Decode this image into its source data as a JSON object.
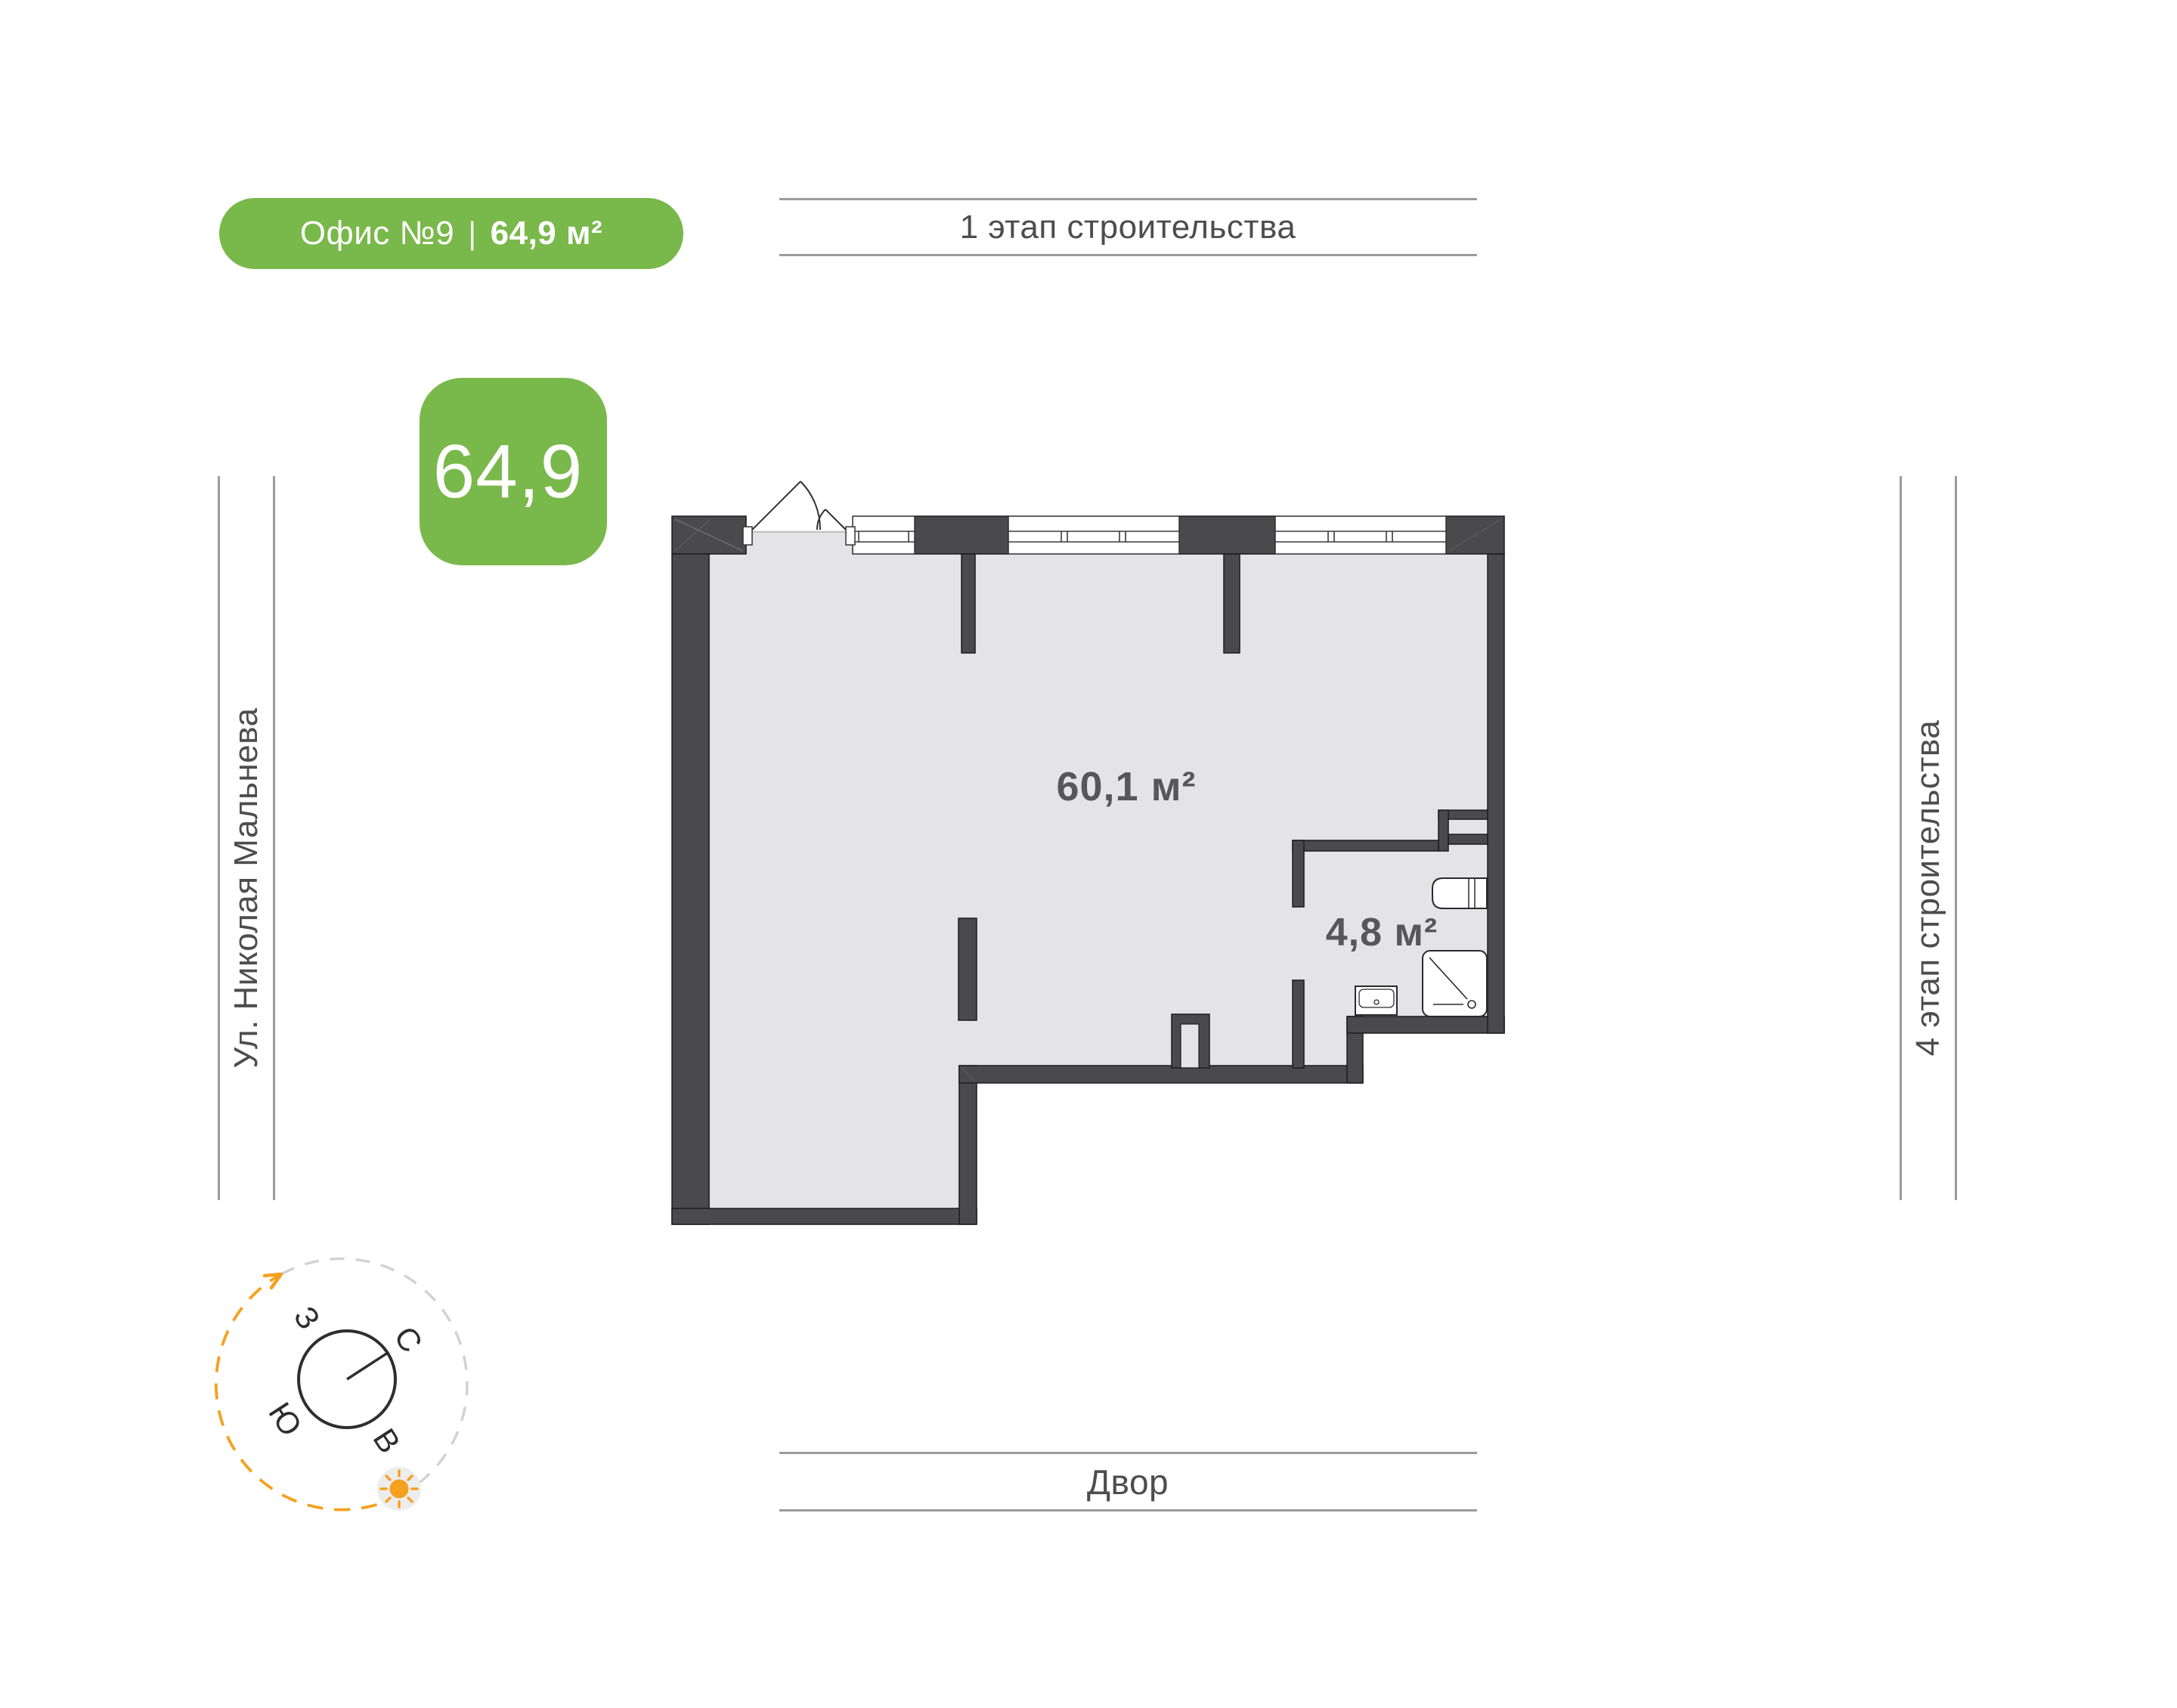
{
  "badge": {
    "title": "Офис №9",
    "separator": "|",
    "area": "64,9 м²"
  },
  "area_tile": {
    "value": "64,9"
  },
  "surroundings": {
    "top": "1 этап строительства",
    "bottom": "Двор",
    "left": "Ул. Николая Мальнева",
    "right": "4 этап строительства"
  },
  "plan": {
    "rooms": [
      {
        "id": "main-room",
        "area_label": "60,1 м²"
      },
      {
        "id": "bathroom",
        "area_label": "4,8 м²"
      }
    ]
  },
  "compass": {
    "north": "С",
    "south": "Ю",
    "west": "З",
    "east": "В"
  },
  "colors": {
    "accent_green": "#79b84a",
    "wall_dark": "#4a4a4c",
    "floor_gray": "#e4e4e6",
    "label_gray": "#57575a",
    "env_text_gray": "#4d4d4f",
    "guide_line_gray": "#9b9b9b",
    "sun_orange": "#f5a11d"
  }
}
